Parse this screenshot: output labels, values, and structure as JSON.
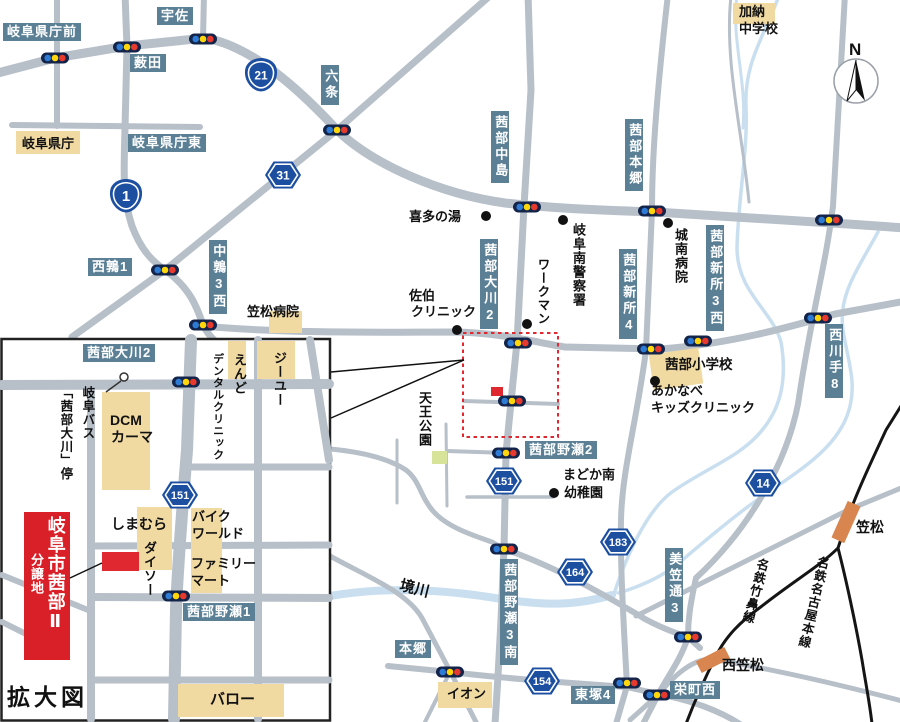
{
  "compass_n": "N",
  "colors": {
    "road": "#b7bfc9",
    "label_bg": "#5b8096",
    "building_tan": "#f1d9a2",
    "accent_red": "#d92028",
    "shield_blue": "#1c4fa0",
    "water_blue": "#c9dff0",
    "railway_black": "#151515",
    "station_orange": "#d8854f",
    "park_green": "#d7e398"
  },
  "shields": {
    "r1": "1",
    "r21": "21",
    "r31": "31",
    "r151": "151",
    "r151_inset": "151",
    "r183": "183",
    "r164": "164",
    "r154": "154",
    "r14": "14"
  },
  "main": {
    "boxed": {
      "kencho_mae": "岐阜県庁前",
      "usa": "宇佐",
      "yabuta": "薮田",
      "kencho_higashi": "岐阜県庁東",
      "rokujo": "六条",
      "nakajima": "茜部中島",
      "akabe_hongo": "茜部本郷",
      "nishi_uzura1": "西鶉1",
      "naka_uzura3": "中鶉3西",
      "okawa2": "茜部大川2",
      "shinsho4": "茜部新所4",
      "shinsho3_nishi": "茜部新所3西",
      "nishikawate8": "西川手8",
      "noze2": "茜部野瀬2",
      "noze3_minami": "茜部野瀬3南",
      "misadori3": "美笠通3",
      "hongo": "本郷",
      "higashizuka4": "東塚4",
      "sakaemachi_nishi": "栄町西"
    },
    "tan": {
      "kencho": "岐阜県庁",
      "ion": "イオン"
    },
    "plain": {
      "kano1": "加納",
      "kano2": "中学校",
      "kitanoyu": "喜多の湯",
      "police": "岐阜南警察署",
      "workman": "ワークマン",
      "saeki1": "佐伯",
      "saeki2": "クリニック",
      "jonan": "城南病院",
      "shogakko": "茜部小学校",
      "akanabe1": "あかなべ",
      "akanabe2": "キッズクリニック",
      "madoka1": "まどか南",
      "madoka2": "幼稚園",
      "tenno": "天王公園",
      "sakaigawa": "境川",
      "kasamatsu_hosp": "笠松病院",
      "kasamatsu_sta": "笠松",
      "nishi_kasamatsu_sta": "西笠松",
      "takehana_line": "名鉄竹鼻線",
      "nagoya_line": "名鉄名古屋本線"
    }
  },
  "inset": {
    "title": "拡大図",
    "boxed": {
      "okawa2": "茜部大川2",
      "noze1": "茜部野瀬1"
    },
    "banner": {
      "line1": "岐阜市茜部Ⅱ",
      "line2": "分譲地"
    },
    "plain": {
      "dcm1": "DCM",
      "dcm2": "カーマ",
      "bus1": "岐阜バス",
      "bus2": "「茜部大川」停",
      "endo": "えんど",
      "dental": "デンタルクリニック",
      "gu": "ジーユー",
      "shimamura": "しまむら",
      "daiso": "ダイソー",
      "bike1": "バイク",
      "bike2": "ワールド",
      "famima1": "ファミリー",
      "famima2": "マート",
      "valor": "バロー"
    }
  }
}
